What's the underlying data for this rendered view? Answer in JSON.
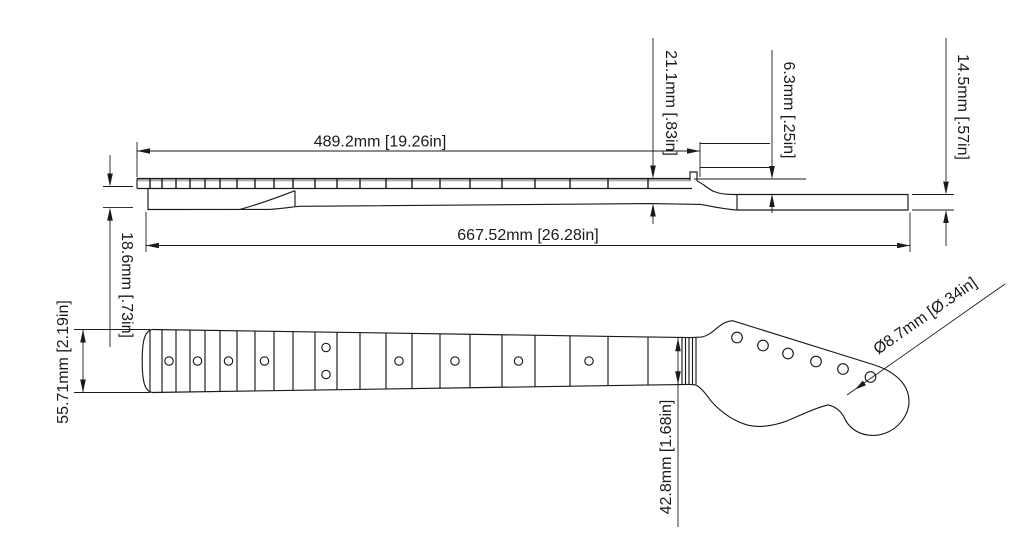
{
  "style": {
    "background": "#ffffff",
    "line_color": "#1a1a1a",
    "fretboard_edge_shade": "#999999"
  },
  "dims": {
    "fretboard_length": "489.2mm [19.26in]",
    "overall_length": "667.52mm [26.28in]",
    "thickness_at_nut": "21.1mm [.83in]",
    "headstock_face_drop": "6.3mm [.25in]",
    "headstock_thickness": "14.5mm [.57in]",
    "neck_shaft_thickness": "18.6mm [.73in]",
    "heel_width": "55.71mm [2.19in]",
    "nut_width": "42.8mm [1.68in]",
    "tuner_hole_diameter": "Ø8.7mm [Ø.34in]"
  }
}
